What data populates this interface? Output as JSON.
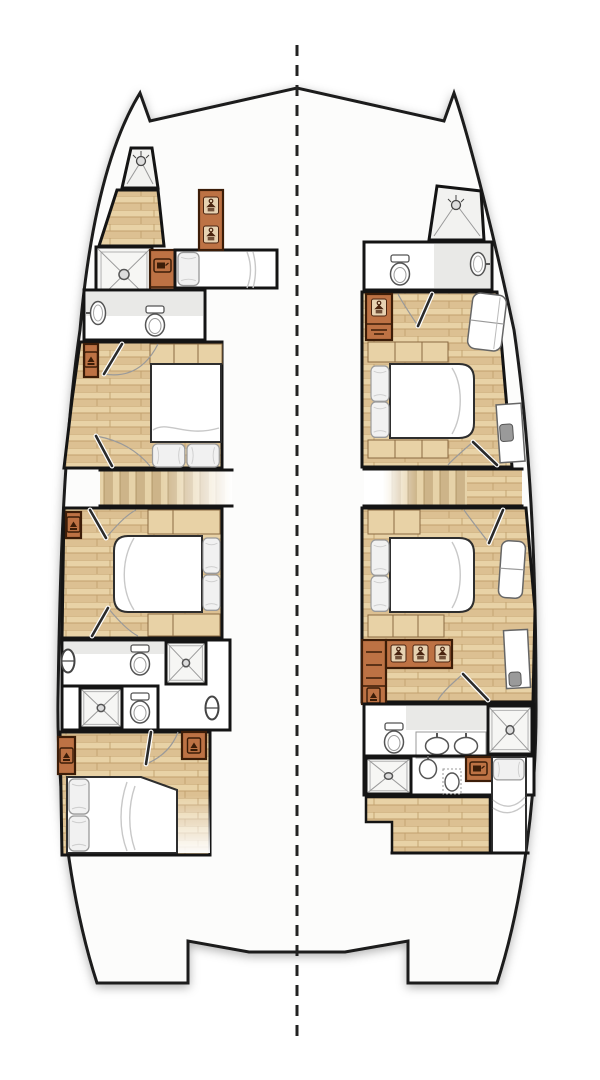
{
  "meta": {
    "diagram_type": "catamaran-interior-deck-plan",
    "orientation": "bow-up",
    "visible_text": "none"
  },
  "colors": {
    "background": "#ffffff",
    "hull_fill": "#fcfcfb",
    "outline": "#1a1a1a",
    "wall": "#141414",
    "wood_a": "#e8d2a6",
    "wood_b": "#dcc092",
    "wood_line": "#c2a06e",
    "stair_a": "#e6d2a8",
    "stair_b": "#cdb489",
    "cabinet": "#bd7244",
    "cabinet_dark": "#3c1d08",
    "fixture_stroke": "#555555",
    "bath_gray": "#e9e9e7",
    "bed_white": "#ffffff",
    "pillow": "#f1f1f1",
    "centerline": "#222222"
  },
  "plan": {
    "centerline_style": "dashed",
    "hulls": [
      {
        "side": "port",
        "rooms": [
          {
            "name": "bow-shower",
            "fixtures": [
              "shower-head",
              "shower-pan"
            ]
          },
          {
            "name": "forepeak",
            "fixtures": [
              "wood-floor",
              "shower-pan",
              "tv-cabinet",
              "single-berth",
              "pillow",
              "wardrobe-2-hangers"
            ]
          },
          {
            "name": "forward-head",
            "fixtures": [
              "sink",
              "toilet"
            ]
          },
          {
            "name": "forward-cabin",
            "fixtures": [
              "double-bed",
              "pillow",
              "pillow",
              "headboard-lockers",
              "wardrobe",
              "door",
              "door",
              "wood-floor"
            ]
          },
          {
            "name": "companionway-stairs",
            "fixtures": [
              "stairs"
            ]
          },
          {
            "name": "mid-cabin",
            "fixtures": [
              "double-bed",
              "pillow",
              "pillow",
              "headboard-lockers",
              "footboard-lockers",
              "wardrobe",
              "door",
              "door",
              "wood-floor"
            ]
          },
          {
            "name": "aft-head",
            "fixtures": [
              "toilet",
              "shower-pan",
              "shower-pan",
              "toilet",
              "porthole",
              "porthole"
            ]
          },
          {
            "name": "aft-cabin",
            "fixtures": [
              "double-bed",
              "pillow",
              "pillow",
              "wardrobe",
              "wardrobe",
              "door",
              "wood-floor"
            ]
          }
        ]
      },
      {
        "side": "starboard",
        "rooms": [
          {
            "name": "bow-shower",
            "fixtures": [
              "shower-head",
              "shower-pan"
            ]
          },
          {
            "name": "forward-head",
            "fixtures": [
              "toilet",
              "sink"
            ]
          },
          {
            "name": "forward-cabin",
            "fixtures": [
              "wardrobe-hanger",
              "sofa",
              "double-bed",
              "pillow",
              "pillow",
              "headboard-lockers",
              "footboard-lockers",
              "desk",
              "chair",
              "door",
              "door",
              "wood-floor"
            ]
          },
          {
            "name": "companionway-stairs",
            "fixtures": [
              "stairs"
            ]
          },
          {
            "name": "mid-cabin",
            "fixtures": [
              "double-bed",
              "pillow",
              "pillow",
              "seat",
              "wardrobe-3-hangers",
              "drawer-unit",
              "locker",
              "desk",
              "chair",
              "door",
              "door",
              "wood-floor"
            ]
          },
          {
            "name": "aft-head",
            "fixtures": [
              "toilet",
              "double-vanity-sinks",
              "shower-pan",
              "shower-pan",
              "sink",
              "toilet",
              "tv-cabinet"
            ]
          },
          {
            "name": "aft-berth",
            "fixtures": [
              "single-berth",
              "pillow",
              "wood-floor"
            ]
          }
        ]
      }
    ]
  }
}
